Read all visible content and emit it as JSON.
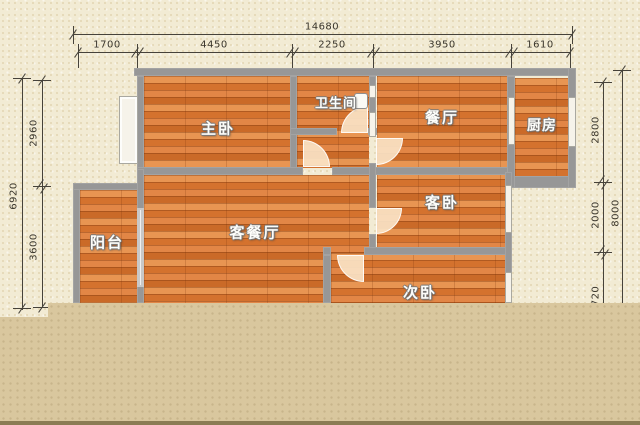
{
  "plan": {
    "title": "apartment-floor-plan",
    "rooms": [
      {
        "id": "master-bedroom",
        "label": "主卧"
      },
      {
        "id": "bathroom",
        "label": "卫生间"
      },
      {
        "id": "dining-room",
        "label": "餐厅"
      },
      {
        "id": "kitchen",
        "label": "厨房"
      },
      {
        "id": "balcony",
        "label": "阳台"
      },
      {
        "id": "living-dining-room",
        "label": "客餐厅"
      },
      {
        "id": "guest-bedroom",
        "label": "客卧"
      },
      {
        "id": "second-bedroom",
        "label": "次卧"
      }
    ],
    "dimensions": {
      "top": {
        "total": "14680",
        "segments": [
          "1700",
          "4450",
          "2250",
          "3950",
          "1610"
        ]
      },
      "left": {
        "total": "6920",
        "segments": [
          "2960",
          "3600"
        ]
      },
      "right": {
        "total": "8000",
        "segments": [
          "2800",
          "2000",
          "720"
        ]
      }
    },
    "colors": {
      "background": "#f2ebd4",
      "wood_floor": "#dd8140",
      "wall": "#979797",
      "tan_block": "#d9c79e",
      "bottom_strip": "#8b7c54",
      "door_leaf": "#fae3c5",
      "dimension_ink": "#46423a"
    }
  }
}
